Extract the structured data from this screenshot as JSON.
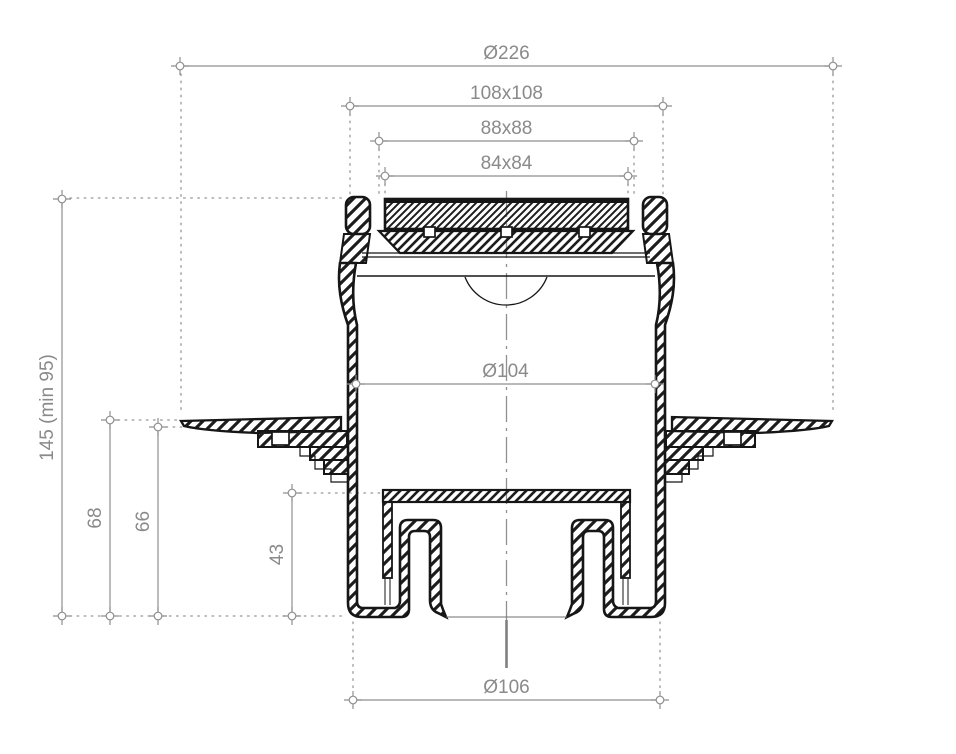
{
  "drawing": {
    "name": "floor-drain-cross-section",
    "colors": {
      "outline": "#161616",
      "dimension": "#8f8f8f",
      "label_text": "#8a8a8a",
      "centerline": "#909090",
      "background": "#ffffff"
    },
    "dimensions": {
      "horizontal": [
        {
          "label": "Ø226",
          "x1": 180,
          "x2": 833,
          "y": 66
        },
        {
          "label": "108x108",
          "x1": 350,
          "x2": 663,
          "y": 106
        },
        {
          "label": "88x88",
          "x1": 379,
          "x2": 634,
          "y": 141
        },
        {
          "label": "84x84",
          "x1": 385,
          "x2": 628,
          "y": 176
        },
        {
          "label": "Ø104",
          "x1": 356,
          "x2": 655,
          "y": 384
        },
        {
          "label": "Ø106",
          "x1": 353,
          "x2": 660,
          "y": 700
        }
      ],
      "vertical": [
        {
          "label": "145 (min 95)",
          "x": 62,
          "y1": 199,
          "y2": 616
        },
        {
          "label": "68",
          "x": 110,
          "y1": 420,
          "y2": 616
        },
        {
          "label": "66",
          "x": 158,
          "y1": 427,
          "y2": 616
        },
        {
          "label": "43",
          "x": 292,
          "y1": 493,
          "y2": 616
        }
      ],
      "font_size": 19
    },
    "extension_lines": {
      "vertical": [
        {
          "x": 181,
          "y1": 74,
          "y2": 414
        },
        {
          "x": 833,
          "y1": 74,
          "y2": 414
        },
        {
          "x": 350,
          "y1": 114,
          "y2": 196
        },
        {
          "x": 663,
          "y1": 114,
          "y2": 196
        },
        {
          "x": 379,
          "y1": 149,
          "y2": 197
        },
        {
          "x": 634,
          "y1": 149,
          "y2": 197
        },
        {
          "x": 385,
          "y1": 184,
          "y2": 197
        },
        {
          "x": 628,
          "y1": 184,
          "y2": 197
        },
        {
          "x": 353,
          "y1": 622,
          "y2": 692
        },
        {
          "x": 660,
          "y1": 622,
          "y2": 692
        }
      ],
      "horizontal": [
        {
          "y": 198,
          "x1": 70,
          "x2": 344
        },
        {
          "y": 420,
          "x1": 118,
          "x2": 181
        },
        {
          "y": 427,
          "x1": 166,
          "x2": 183
        },
        {
          "y": 493,
          "x1": 300,
          "x2": 381
        },
        {
          "y": 616,
          "x1": 70,
          "x2": 346
        }
      ]
    },
    "centerline": {
      "x": 506.5,
      "y1": 191,
      "y2": 620,
      "solid_y1": 620,
      "solid_y2": 668
    }
  }
}
